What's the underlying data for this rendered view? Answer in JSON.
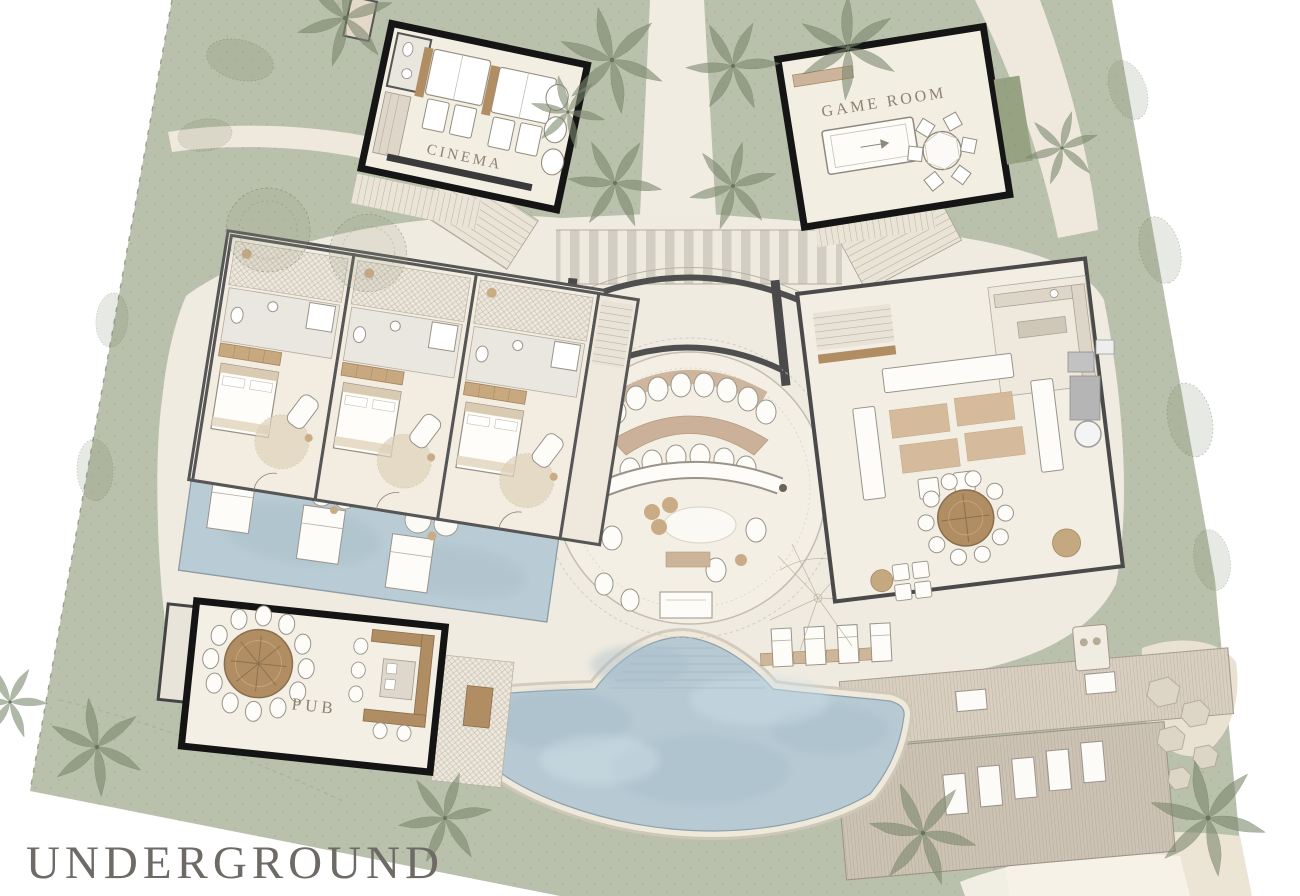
{
  "page": {
    "title": "UNDERGROUND"
  },
  "plan": {
    "rooms": [
      {
        "id": "cinema",
        "label": "CINEMA"
      },
      {
        "id": "game-room",
        "label": "GAME ROOM"
      },
      {
        "id": "pub",
        "label": "PUB"
      }
    ],
    "colors": {
      "landscape_green": "#b9c0ab",
      "terrace_cream": "#f0ebe0",
      "floor_cream": "#f4efe4",
      "pool_blue": "#b7cad4",
      "building_outline": "#151515",
      "wall_gray": "#4f4f4f",
      "wood_tan": "#b08d62",
      "rug_tan": "#cdb49a",
      "deck_wood": "#cdc3b4",
      "title_gray": "#6e6a65",
      "label_brown": "#8d8272"
    }
  }
}
